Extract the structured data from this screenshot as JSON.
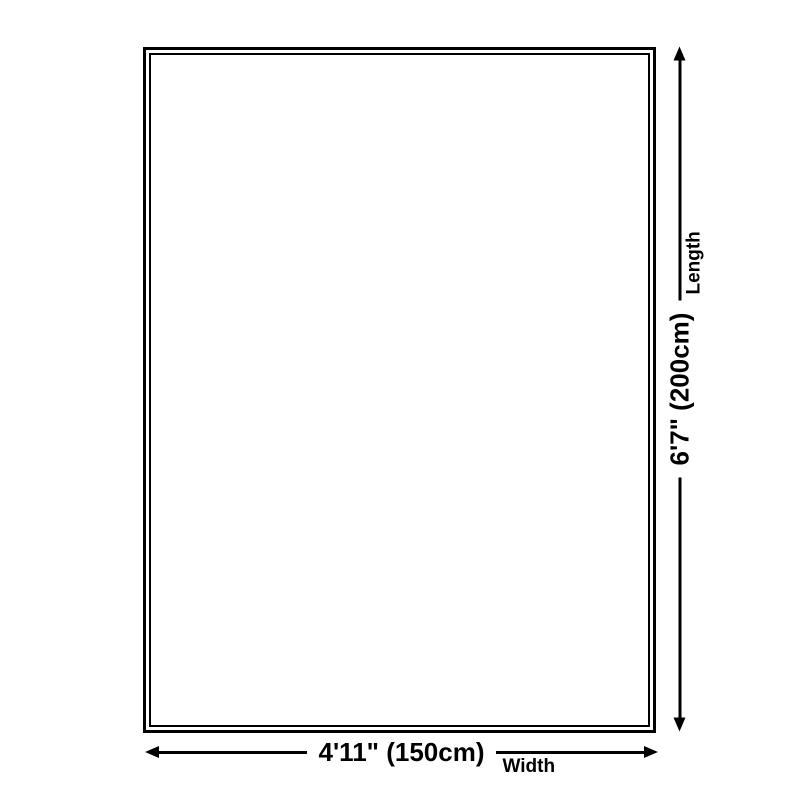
{
  "colors": {
    "background": "#ffffff",
    "line": "#000000",
    "text": "#000000"
  },
  "diagram": {
    "name": "product-size-diagram",
    "shape": "rectangle-double-border"
  },
  "dimensions": {
    "length": {
      "value": "6'7\" (200cm)",
      "label": "Length"
    },
    "width": {
      "value": "4'11\" (150cm)",
      "label": "Width"
    }
  },
  "icons": {
    "arrow_up": "css-triangle-up",
    "arrow_down": "css-triangle-down",
    "arrow_left": "css-triangle-left",
    "arrow_right": "css-triangle-right"
  }
}
